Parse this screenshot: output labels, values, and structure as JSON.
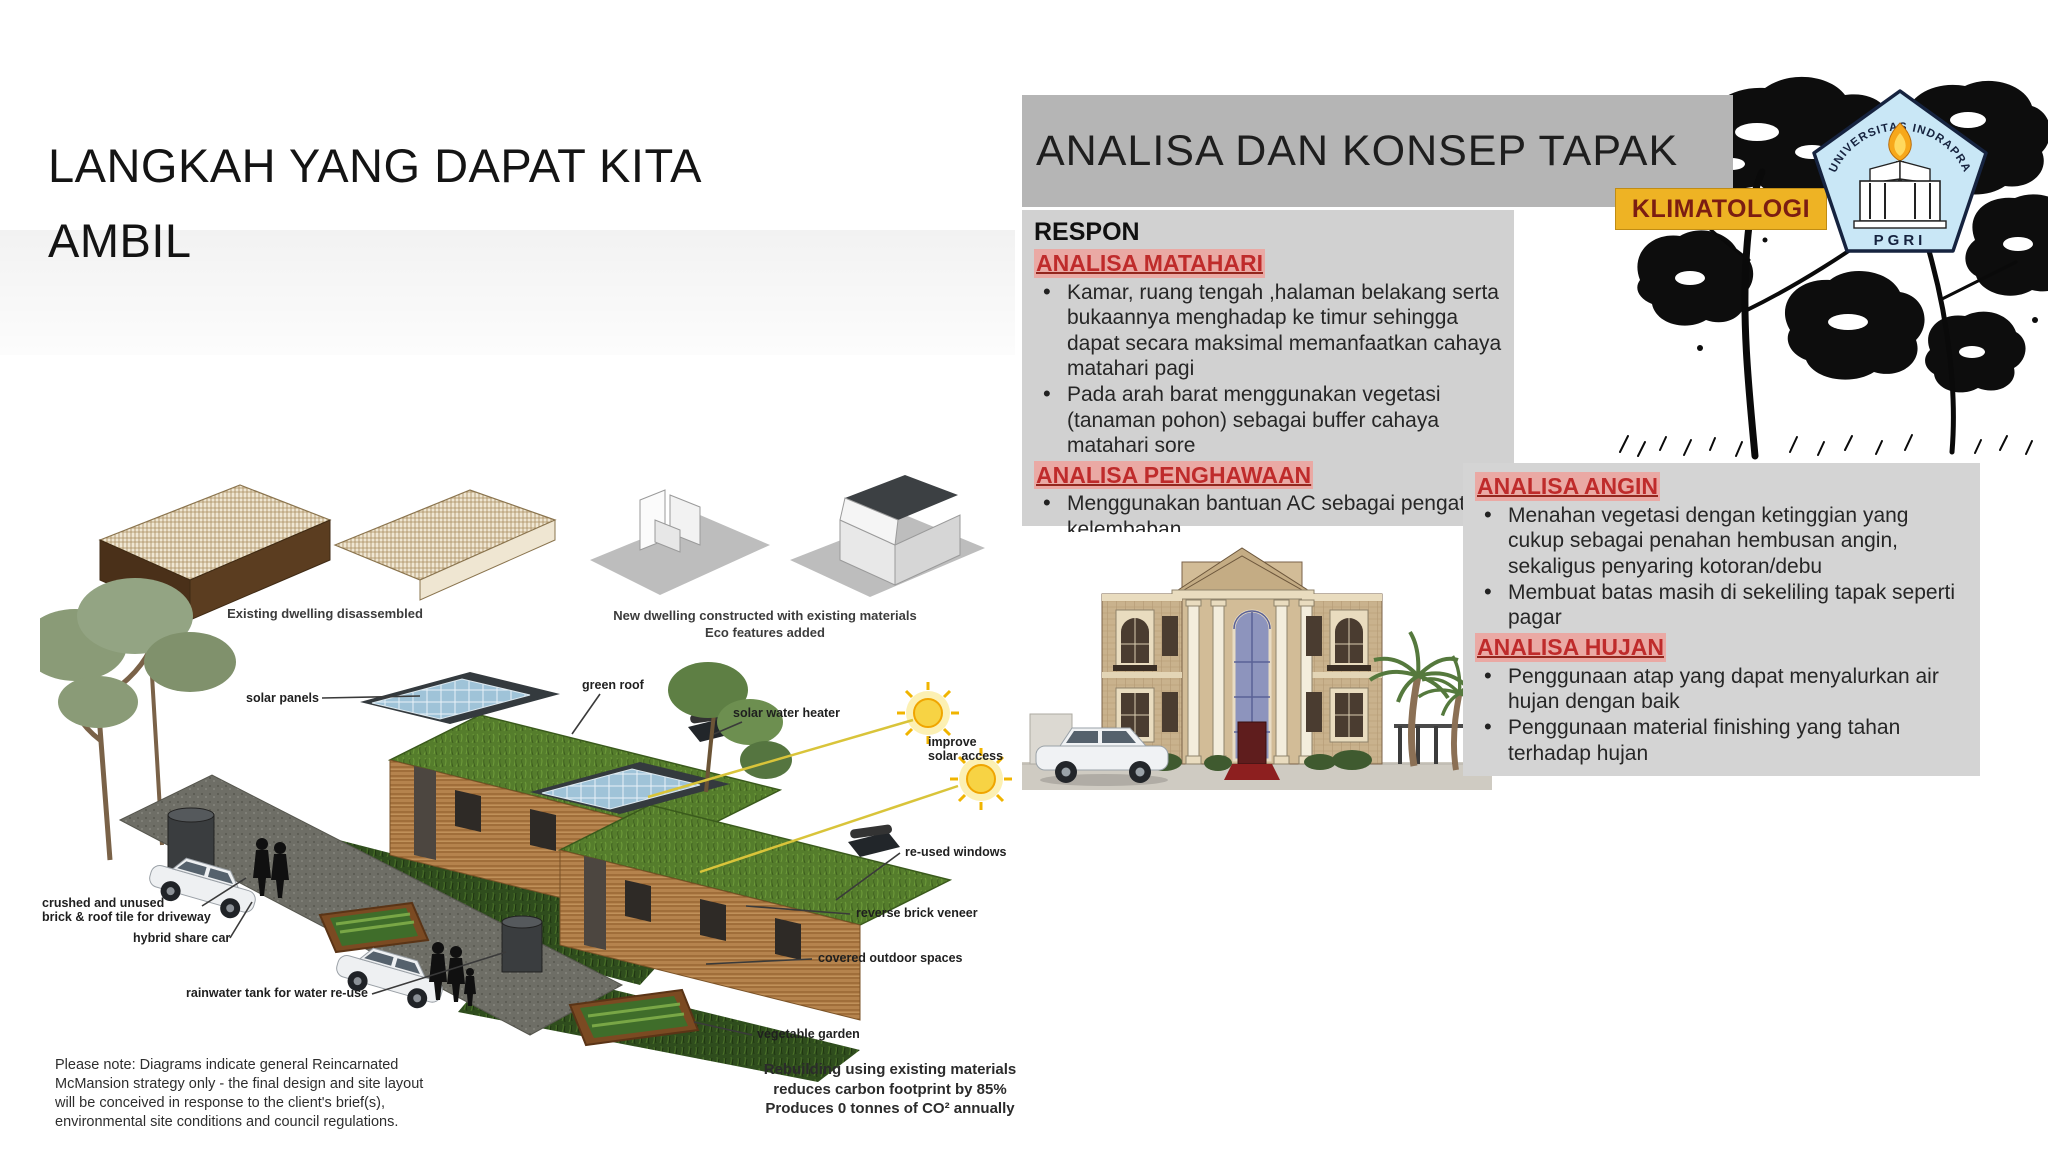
{
  "slide": {
    "title": "LANGKAH YANG DAPAT KITA AMBIL"
  },
  "header": {
    "title": "ANALISA DAN KONSEP TAPAK",
    "badge": "KLIMATOLOGI"
  },
  "logo": {
    "arc_text": "UNIVERSITAS INDRAPRASTA",
    "bottom_text": "PGRI"
  },
  "respon": {
    "title": "RESPON",
    "matahari": {
      "heading": "ANALISA MATAHARI",
      "bullets": [
        "Kamar, ruang tengah ,halaman belakang serta bukaannya menghadap ke timur sehingga dapat secara maksimal memanfaatkan cahaya matahari pagi",
        "Pada arah barat menggunakan vegetasi (tanaman pohon) sebagai buffer cahaya matahari sore"
      ]
    },
    "penghawaan": {
      "heading": "ANALISA PENGHAWAAN",
      "bullets": [
        "Menggunakan bantuan AC sebagai pengatur kelembaban"
      ]
    }
  },
  "angin": {
    "heading": "ANALISA ANGIN",
    "bullets": [
      "Menahan vegetasi dengan ketinggian yang cukup sebagai penahan hembusan angin, sekaligus penyaring kotoran/debu",
      "Membuat batas masih di sekeliling tapak seperti pagar"
    ]
  },
  "hujan": {
    "heading": "ANALISA HUJAN",
    "bullets": [
      "Penggunaan atap yang dapat menyalurkan air hujan dengan baik",
      "Penggunaan material finishing yang tahan terhadap hujan"
    ]
  },
  "diagram": {
    "captions": {
      "existing": "Existing dwelling disassembled",
      "new_dwelling": "New dwelling constructed with existing materials\nEco features added"
    },
    "labels": {
      "solar_panels": "solar panels",
      "green_roof": "green roof",
      "solar_water_heater": "solar water heater",
      "improve_solar": "improve\nsolar access",
      "reused_windows": "re-used windows",
      "reverse_brick": "reverse brick veneer",
      "covered_outdoor": "covered outdoor spaces",
      "vegetable_garden": "vegetable garden",
      "crushed_brick": "crushed and unused\nbrick & roof tile for driveway",
      "hybrid_car": "hybrid share car",
      "rainwater_tank": "rainwater tank for water re-use"
    },
    "note": "Please note: Diagrams indicate general Reincarnated\nMcMansion strategy only - the final design and site layout\nwill be conceived in response to the client's brief(s),\nenvironmental site conditions and council regulations.",
    "impact": "Rebuilding using existing materials\nreduces carbon footprint by 85%\nProduces 0 tonnes of CO² annually"
  }
}
